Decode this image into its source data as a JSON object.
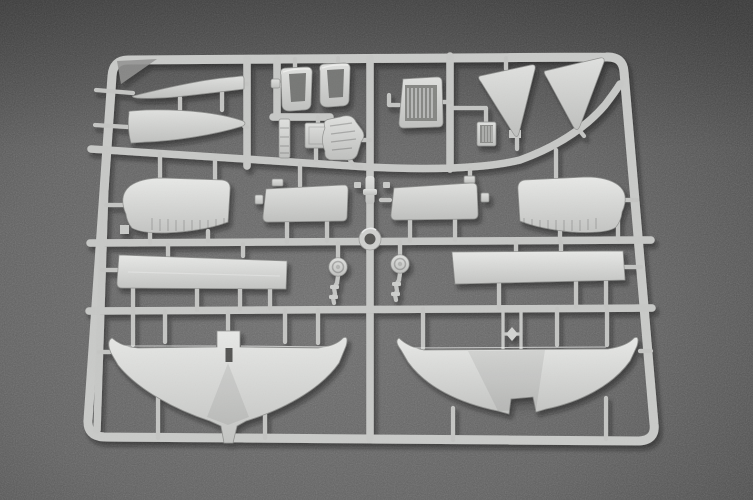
{
  "scene": {
    "type": "photograph",
    "subject": "Light gray injection-molded styrene sprue (parts tree) from a model aircraft kit, lying on a dark gray speckled surface",
    "alt_text": "A light gray plastic model-kit sprue holding unpainted aircraft parts - wing pieces, tail planes, triangular fins, cockpit seats, a radiator, an engine block, landing-gear wheels and flat strips - all attached to a rectangular runner frame photographed on a dark textured background."
  },
  "palette": {
    "background_base": "#5e5e5e",
    "background_shadow": "#454545",
    "plastic_light": "#e6e7e5",
    "plastic_base": "#cbccca",
    "plastic_shadow": "#9a9b99",
    "recess_dark": "#6b6c6a"
  },
  "sprue": {
    "frame": "rounded rectangular runner frame with inner rails",
    "rails": [
      "top",
      "upper-middle curved",
      "middle",
      "lower-middle",
      "bottom"
    ],
    "parts": [
      {
        "id": "fuselage-spine-upper",
        "desc": "long tapered blade part, top left"
      },
      {
        "id": "fuselage-spine-lower",
        "desc": "long tapered blade part, top left lower"
      },
      {
        "id": "seat-left",
        "desc": "bucket seat"
      },
      {
        "id": "seat-right",
        "desc": "bucket seat"
      },
      {
        "id": "radiator",
        "desc": "rectangular radiator with vertical grille"
      },
      {
        "id": "engine-block",
        "desc": "small lumpy engine casting"
      },
      {
        "id": "exhaust-stack",
        "desc": "narrow ribbed strip"
      },
      {
        "id": "bulkhead-plate",
        "desc": "small rectangular plate"
      },
      {
        "id": "fin-left",
        "desc": "triangular tail fin"
      },
      {
        "id": "fin-right",
        "desc": "triangular tail fin"
      },
      {
        "id": "hatch-plate",
        "desc": "small ribbed access plate"
      },
      {
        "id": "tailplane-left",
        "desc": "rounded stabilizer with ribbed trailing edge"
      },
      {
        "id": "tailplane-right",
        "desc": "rounded stabilizer with ribbed trailing edge"
      },
      {
        "id": "cowl-panel-left",
        "desc": "rectangular cowling panel"
      },
      {
        "id": "cowl-panel-right",
        "desc": "rectangular cowling panel"
      },
      {
        "id": "cowl-ring",
        "desc": "small ring at runner crossing"
      },
      {
        "id": "gear-leg-left",
        "desc": "landing-gear wheel and strut"
      },
      {
        "id": "gear-leg-right",
        "desc": "landing-gear wheel and strut"
      },
      {
        "id": "wing-spar-left",
        "desc": "long flat strip"
      },
      {
        "id": "wing-spar-right",
        "desc": "long flat strip"
      },
      {
        "id": "ladder-frame",
        "desc": "small H-shaped strut frame"
      },
      {
        "id": "lower-wing",
        "desc": "one-piece gull wing with center tab and slot"
      },
      {
        "id": "upper-wing",
        "desc": "one-piece wing with upturned tips and center notch"
      }
    ]
  }
}
